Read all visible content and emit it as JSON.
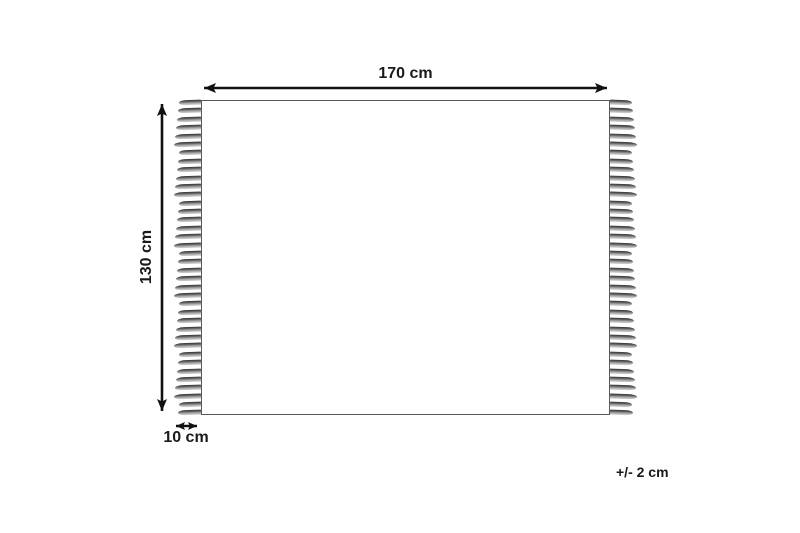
{
  "diagram": {
    "type": "product-dimension-diagram",
    "subject": "rug with fringe, top-down outline",
    "labels": {
      "width": "170 cm",
      "height": "130 cm",
      "fringe": "10 cm",
      "tolerance": "+/- 2 cm"
    },
    "colors": {
      "background": "#ffffff",
      "arrow": "#111111",
      "text": "#1a1a1a",
      "rug_border": "#595959",
      "tassel_dark": "#343434",
      "tassel_light": "#d6d6d6"
    }
  }
}
